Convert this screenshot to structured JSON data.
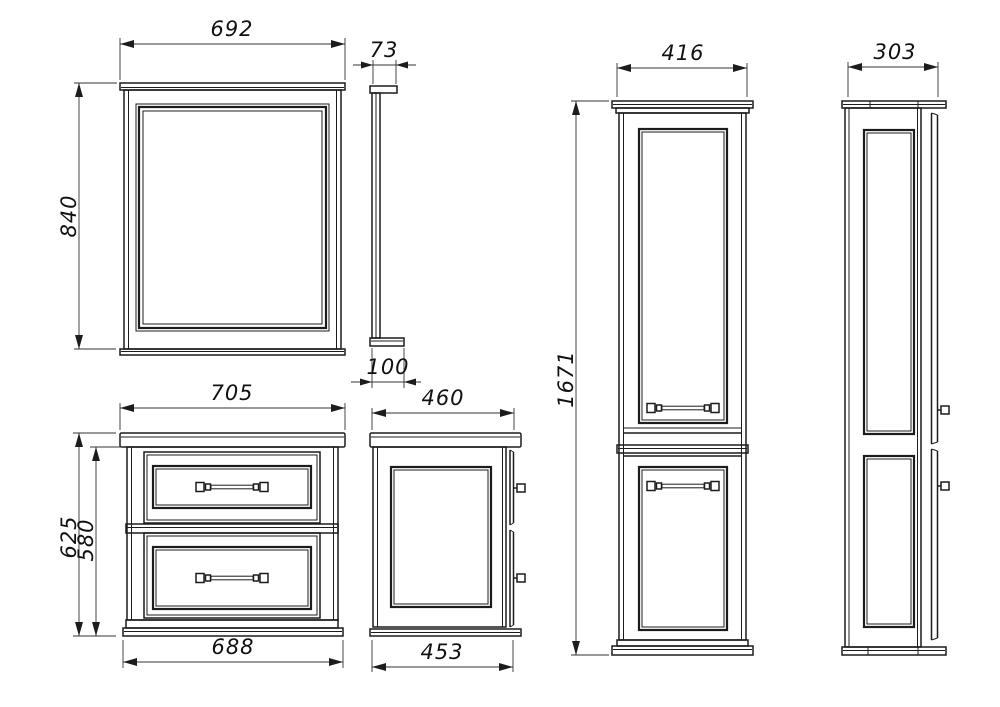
{
  "colors": {
    "background": "#ffffff",
    "line": "#1c1c1c",
    "dimension_line": "#333333",
    "text": "#111111"
  },
  "views": {
    "mirror_front": {
      "label_width": "692",
      "label_height": "840"
    },
    "mirror_side": {
      "label_top_depth": "73",
      "label_bottom_depth": "100"
    },
    "vanity_front": {
      "label_top_width": "705",
      "label_total_height": "625",
      "label_body_height": "580",
      "label_bottom_width": "688"
    },
    "vanity_side": {
      "label_top_depth": "460",
      "label_bottom_depth": "453"
    },
    "cabinet_front": {
      "label_width": "416",
      "label_height": "1671"
    },
    "cabinet_side": {
      "label_depth": "303"
    }
  }
}
